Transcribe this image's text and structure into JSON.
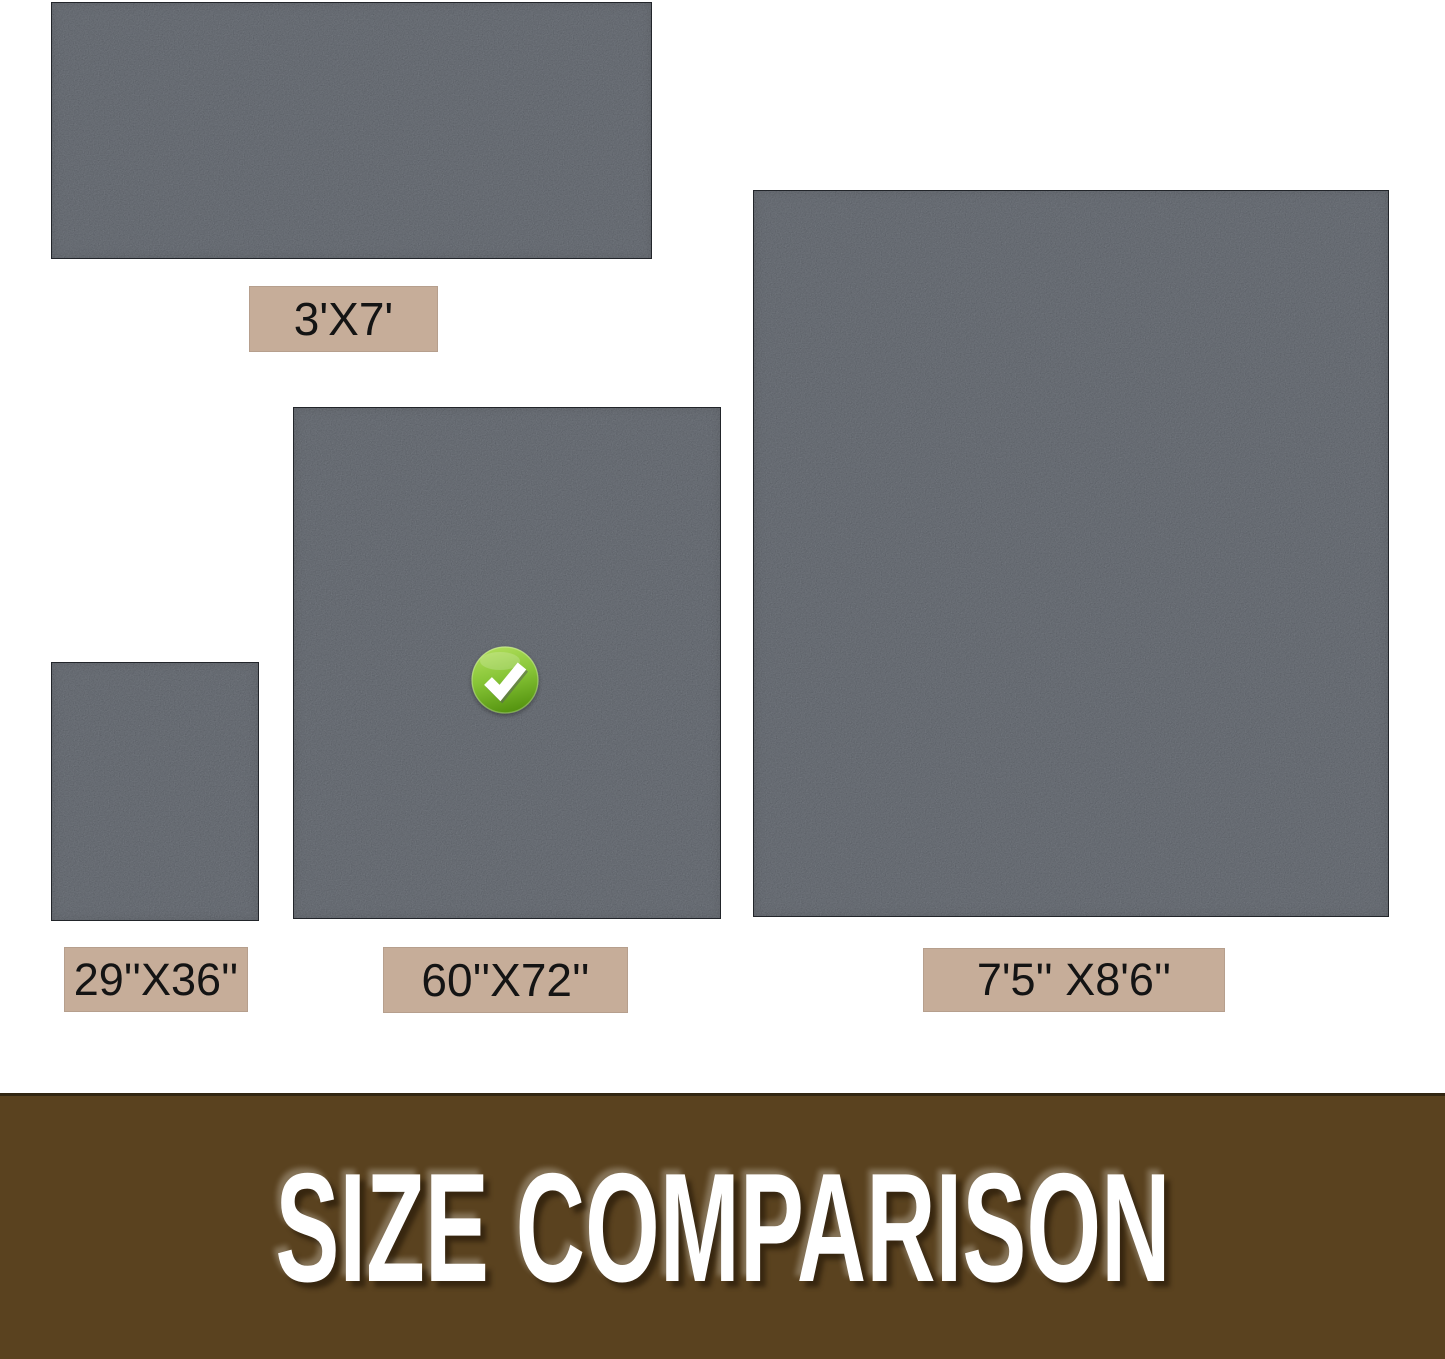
{
  "graphic": {
    "type": "product-size-comparison",
    "background": "#ffffff",
    "mats": [
      {
        "name": "mat-3x7",
        "label": "3'X7'",
        "selected": false
      },
      {
        "name": "mat-29x36",
        "label": "29''X36''",
        "selected": false
      },
      {
        "name": "mat-60x72",
        "label": "60''X72''",
        "selected": true
      },
      {
        "name": "mat-7'5x8'6",
        "label": "7'5'' X8'6''",
        "selected": false
      }
    ],
    "icons": {
      "check": {
        "name": "check-icon",
        "glyph": "✔",
        "meaning": "selected size",
        "color": "#76b82d"
      }
    },
    "banner": {
      "title": "SIZE COMPARISON",
      "background": "#5a421f",
      "text_color": "#ffffff"
    },
    "colors": {
      "mat_fill": "#3b3f45",
      "mat_edge": "#22252a",
      "label_background": "#c6ad99",
      "label_text": "#141414",
      "banner_brown": "#5a421f",
      "check_green": "#76b82d"
    }
  }
}
